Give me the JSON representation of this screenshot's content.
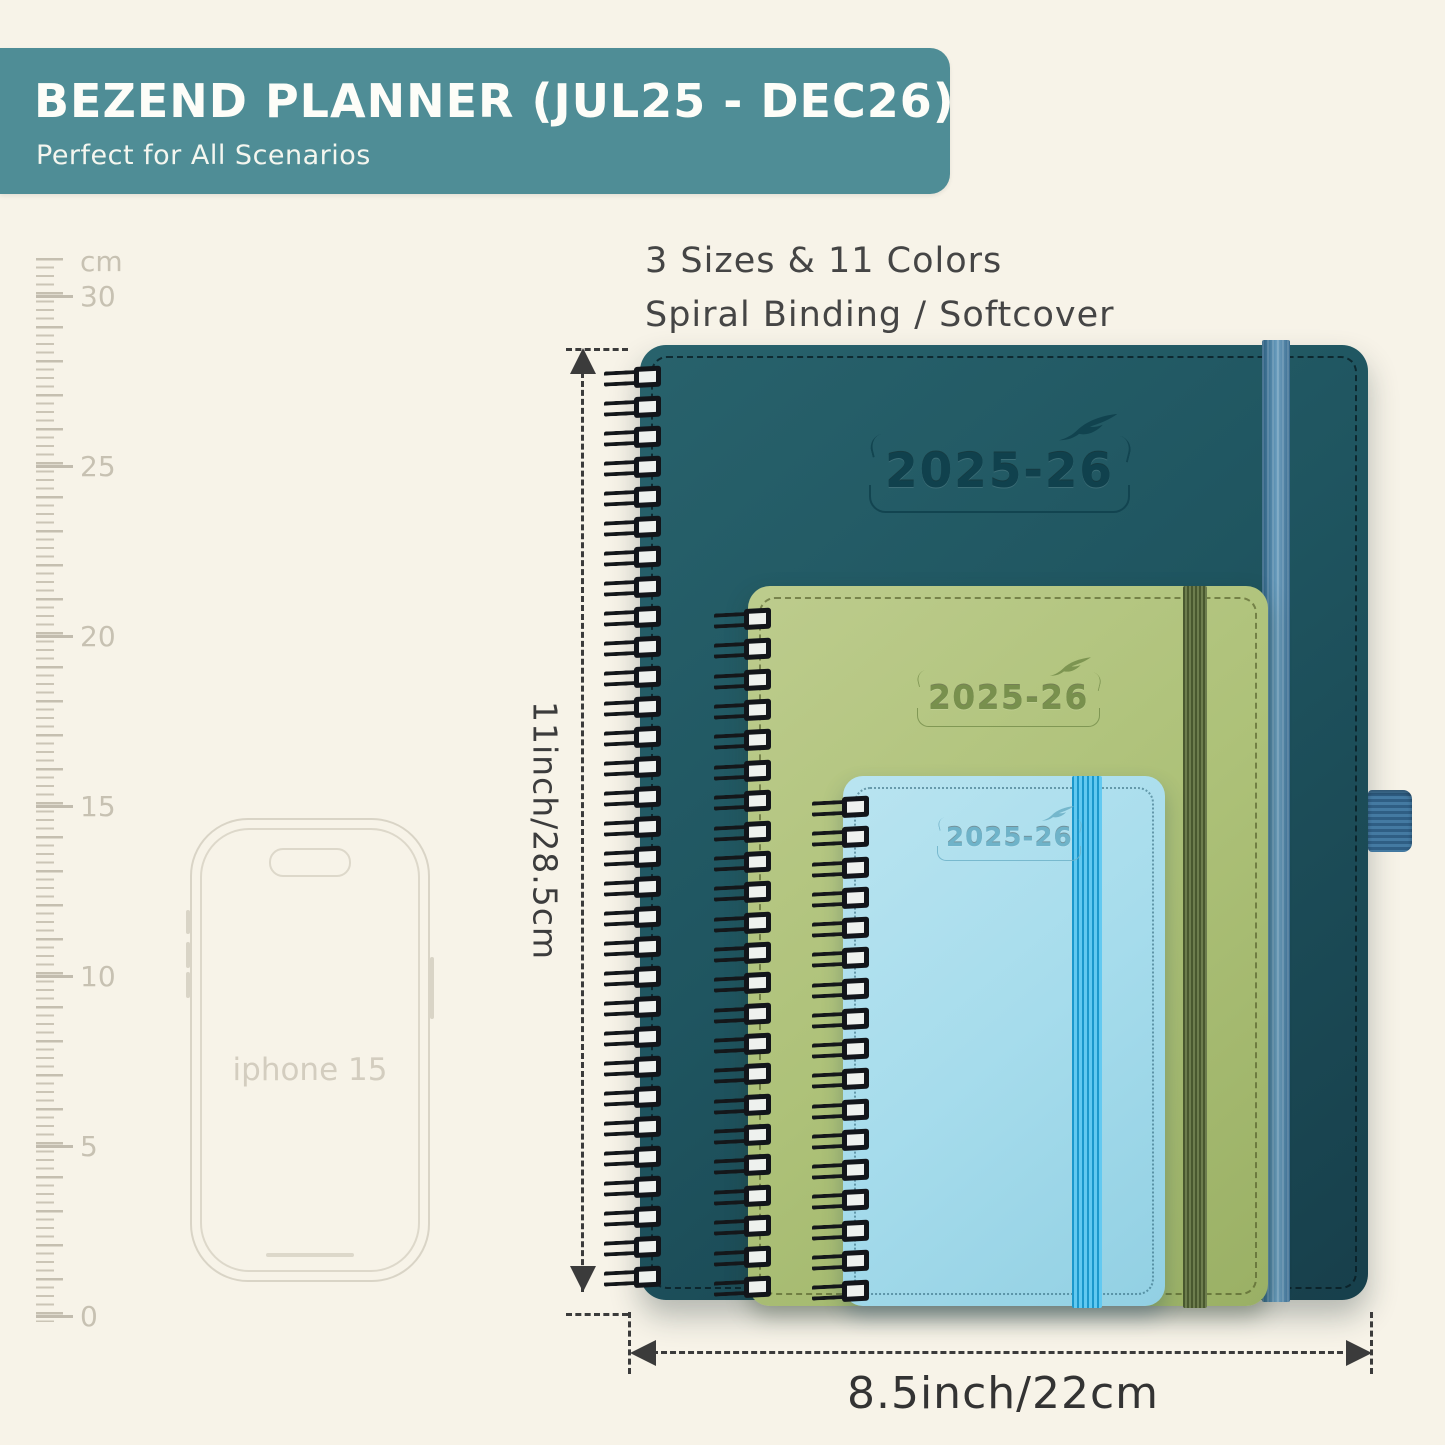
{
  "banner": {
    "title": "BEZEND PLANNER (JUL25 - DEC26)",
    "subtitle": "Perfect for All Scenarios"
  },
  "features": {
    "line1": "3 Sizes & 11 Colors",
    "line2": "Spiral Binding / Softcover"
  },
  "ruler": {
    "labels": [
      "cm",
      "30",
      "25",
      "20",
      "15",
      "10",
      "5",
      "0"
    ]
  },
  "phone": {
    "label": "iphone 15"
  },
  "planners": [
    {
      "size": "large",
      "year": "2025-26"
    },
    {
      "size": "medium",
      "year": "2025-26"
    },
    {
      "size": "small",
      "year": "2025-26"
    }
  ],
  "dimensions": {
    "height_label": "11inch/28.5cm",
    "width_label": "8.5inch/22cm"
  },
  "colors": {
    "background": "#f7f3e8",
    "banner_bg": "#4f8d96",
    "planner_large": "#1f5560",
    "planner_medium": "#adc178",
    "planner_small": "#a6dcec",
    "elastic_large": "#5d92b4",
    "elastic_medium": "#59693f",
    "elastic_small": "#2fb3e8",
    "dimension_text": "#3b3b3b"
  }
}
